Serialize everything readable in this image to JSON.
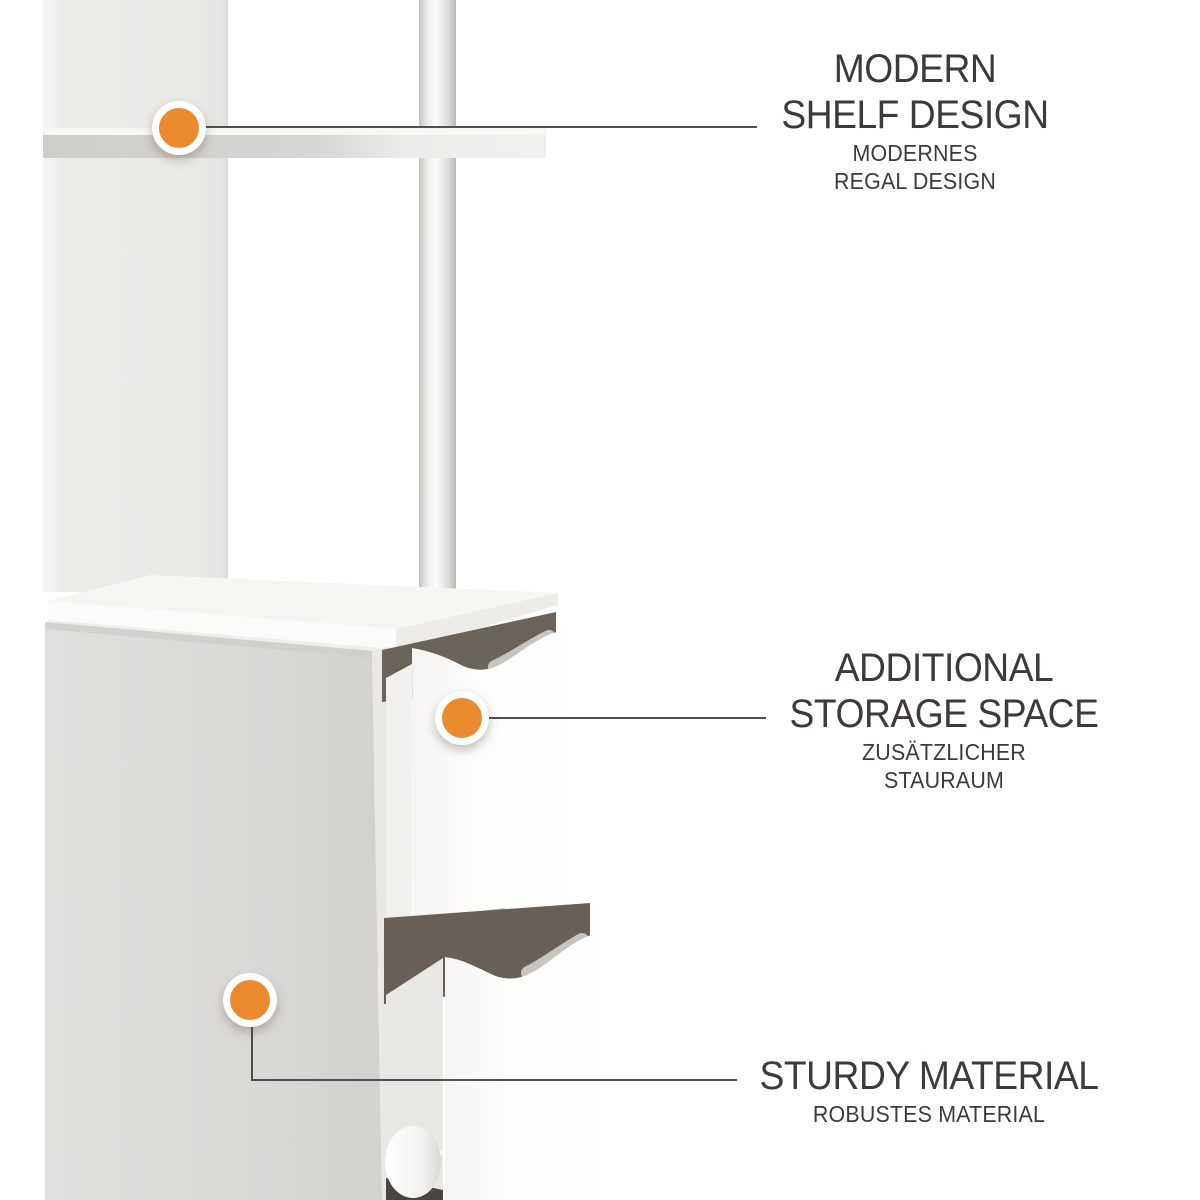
{
  "theme": {
    "accent_color": "#EB8A2E",
    "line_color": "#4F4F4F",
    "text_color": "#3E3A38",
    "background_color": "#FFFFFF"
  },
  "features": [
    {
      "id": "modern-shelf-design",
      "title": [
        "MODERN",
        "SHELF DESIGN"
      ],
      "subtitle": [
        "MODERNES",
        "REGAL DESIGN"
      ]
    },
    {
      "id": "additional-storage-space",
      "title": [
        "ADDITIONAL",
        "STORAGE SPACE"
      ],
      "subtitle": [
        "ZUSÄTZLICHER",
        "STAURAUM"
      ]
    },
    {
      "id": "sturdy-material",
      "title": [
        "STURDY MATERIAL"
      ],
      "subtitle": [
        "ROBUSTES MATERIAL"
      ]
    }
  ]
}
